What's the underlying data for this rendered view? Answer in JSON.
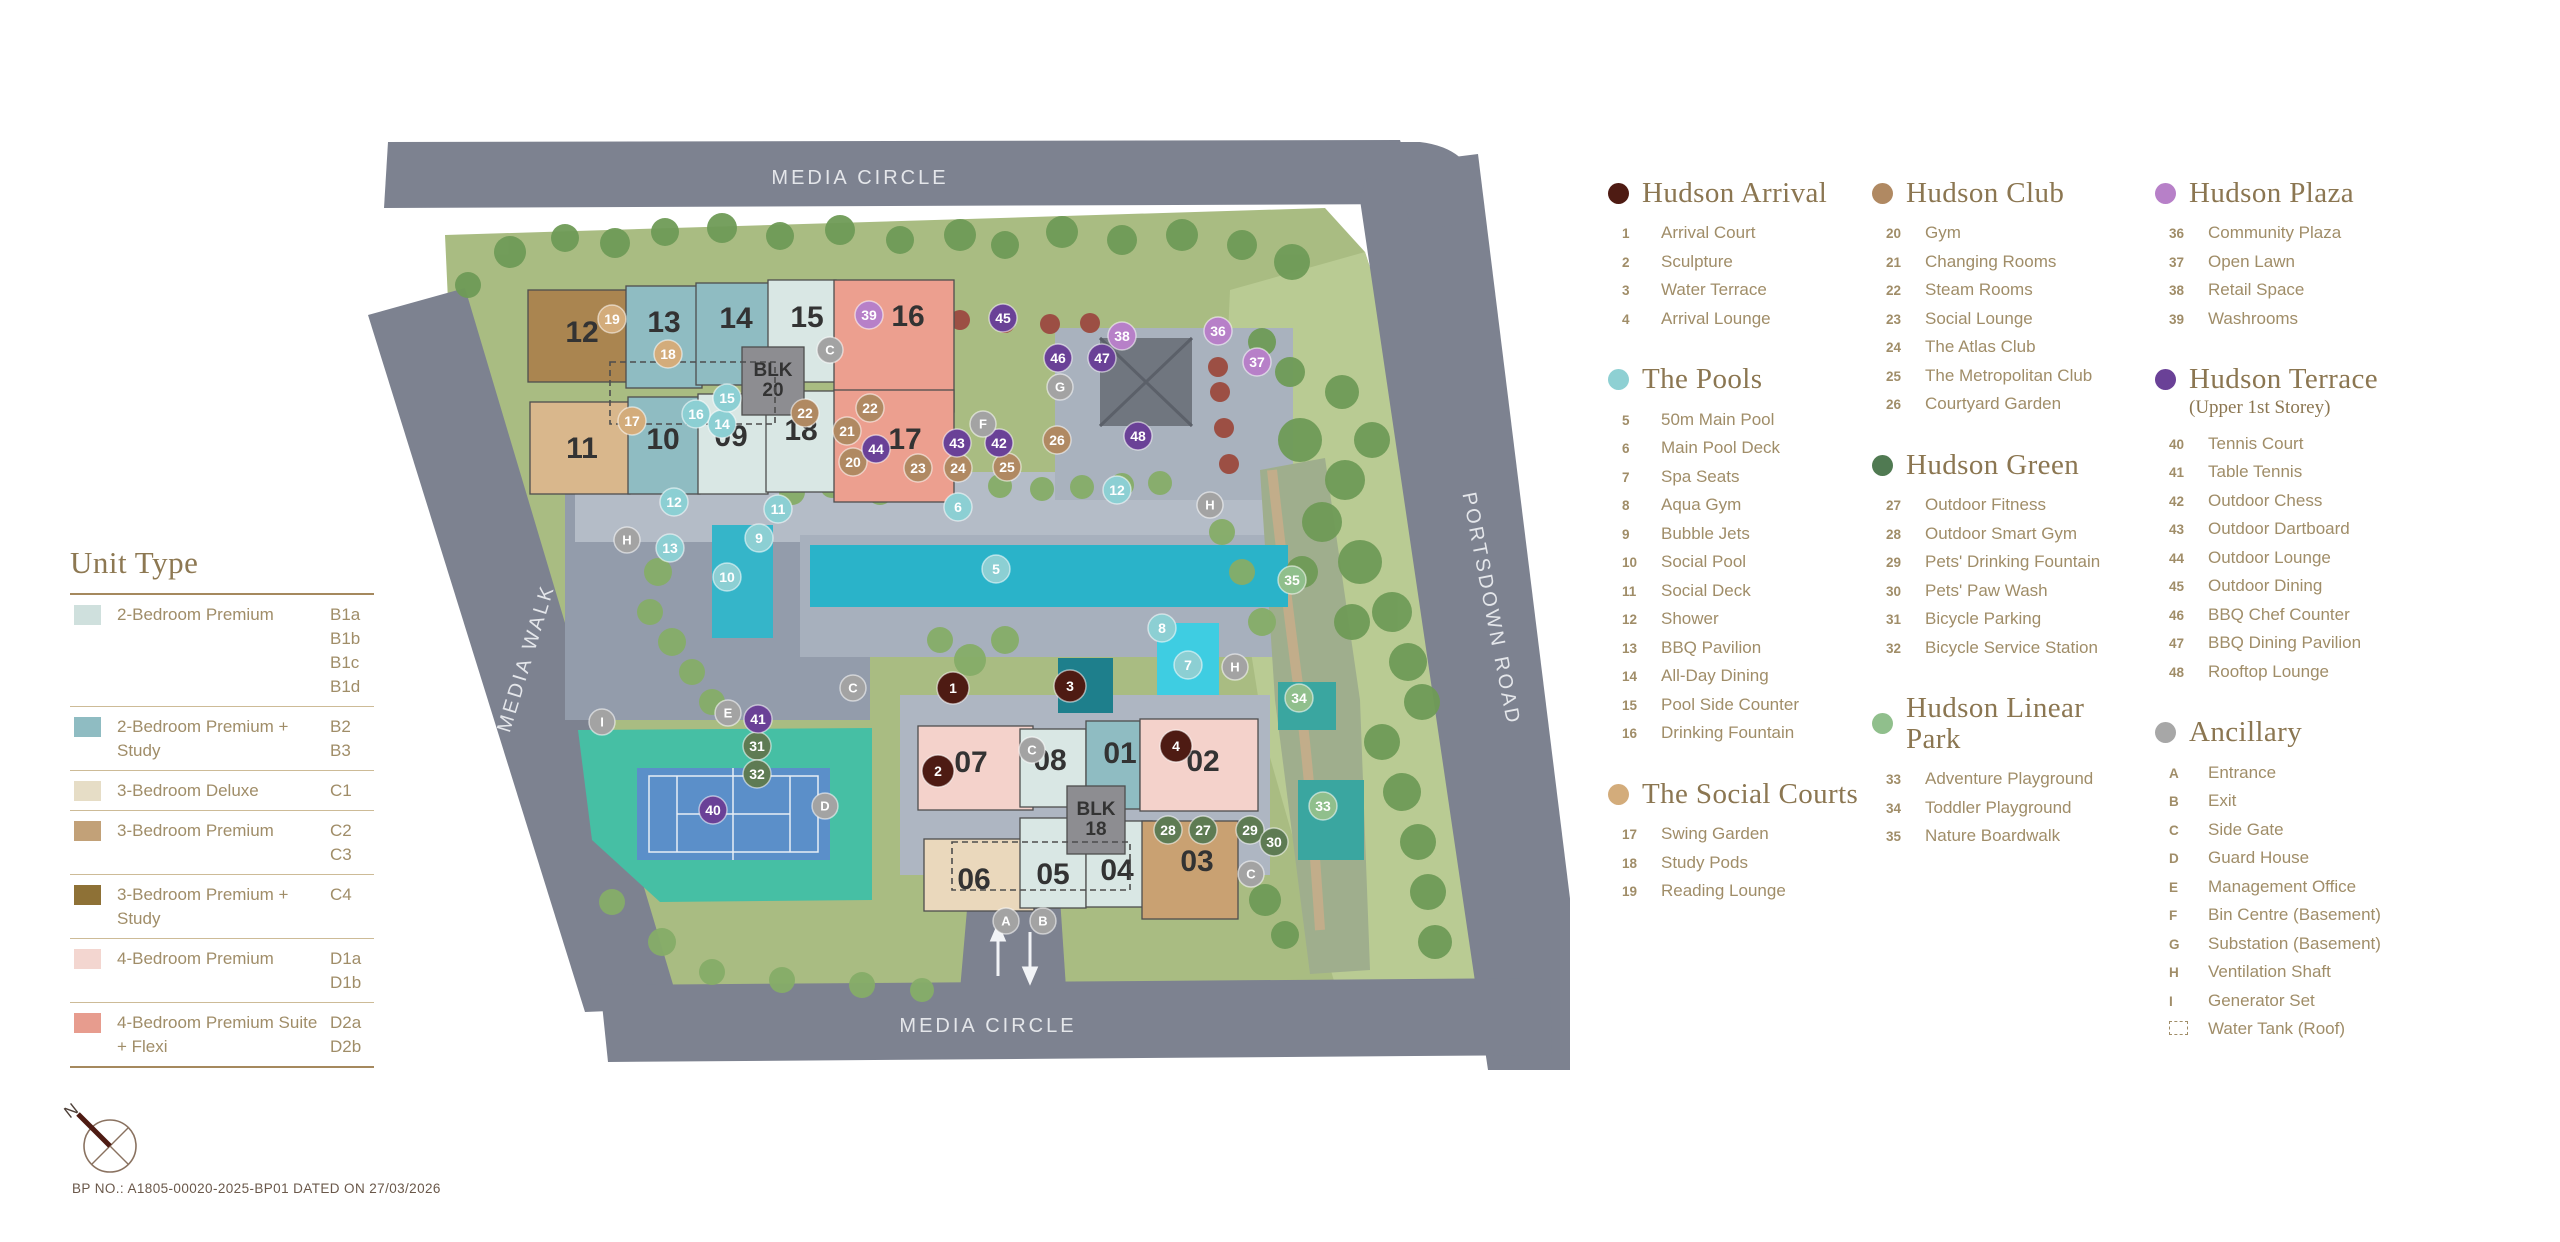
{
  "page": {
    "bp_note": "BP NO.: A1805-00020-2025-BP01 DATED ON 27/03/2026",
    "north_label": "N"
  },
  "unit_legend": {
    "title": "Unit Type",
    "rows": [
      {
        "label": "2-Bedroom Premium",
        "codes": [
          "B1a",
          "B1b",
          "B1c",
          "B1d"
        ],
        "color": "#cfe0dd"
      },
      {
        "label": "2-Bedroom Premium + Study",
        "codes": [
          "B2",
          "B3"
        ],
        "color": "#8fbcc2"
      },
      {
        "label": "3-Bedroom Deluxe",
        "codes": [
          "C1"
        ],
        "color": "#e6ddc6"
      },
      {
        "label": "3-Bedroom Premium",
        "codes": [
          "C2",
          "C3"
        ],
        "color": "#c2a178"
      },
      {
        "label": "3-Bedroom Premium + Study",
        "codes": [
          "C4"
        ],
        "color": "#8e7136"
      },
      {
        "label": "4-Bedroom Premium",
        "codes": [
          "D1a",
          "D1b"
        ],
        "color": "#f3d6d0"
      },
      {
        "label": "4-Bedroom Premium Suite + Flexi",
        "codes": [
          "D2a",
          "D2b"
        ],
        "color": "#e79c8e"
      }
    ]
  },
  "legend_columns": [
    [
      {
        "title": "Hudson Arrival",
        "color": "#4e1b13",
        "items": [
          {
            "k": "1",
            "label": "Arrival Court"
          },
          {
            "k": "2",
            "label": "Sculpture"
          },
          {
            "k": "3",
            "label": "Water Terrace"
          },
          {
            "k": "4",
            "label": "Arrival Lounge"
          }
        ]
      },
      {
        "title": "The Pools",
        "color": "#8ed0d3",
        "items": [
          {
            "k": "5",
            "label": "50m Main Pool"
          },
          {
            "k": "6",
            "label": "Main Pool Deck"
          },
          {
            "k": "7",
            "label": "Spa Seats"
          },
          {
            "k": "8",
            "label": "Aqua Gym"
          },
          {
            "k": "9",
            "label": "Bubble Jets"
          },
          {
            "k": "10",
            "label": "Social Pool"
          },
          {
            "k": "11",
            "label": "Social Deck"
          },
          {
            "k": "12",
            "label": "Shower"
          },
          {
            "k": "13",
            "label": "BBQ Pavilion"
          },
          {
            "k": "14",
            "label": "All-Day Dining"
          },
          {
            "k": "15",
            "label": "Pool Side Counter"
          },
          {
            "k": "16",
            "label": "Drinking Fountain"
          }
        ]
      },
      {
        "title": "The Social Courts",
        "color": "#d3ac7b",
        "items": [
          {
            "k": "17",
            "label": "Swing Garden"
          },
          {
            "k": "18",
            "label": "Study Pods"
          },
          {
            "k": "19",
            "label": "Reading Lounge"
          }
        ]
      }
    ],
    [
      {
        "title": "Hudson Club",
        "color": "#b08962",
        "items": [
          {
            "k": "20",
            "label": "Gym"
          },
          {
            "k": "21",
            "label": "Changing Rooms"
          },
          {
            "k": "22",
            "label": "Steam Rooms"
          },
          {
            "k": "23",
            "label": "Social Lounge"
          },
          {
            "k": "24",
            "label": "The Atlas Club"
          },
          {
            "k": "25",
            "label": "The Metropolitan Club"
          },
          {
            "k": "26",
            "label": "Courtyard Garden"
          }
        ]
      },
      {
        "title": "Hudson Green",
        "color": "#507a52",
        "items": [
          {
            "k": "27",
            "label": "Outdoor Fitness"
          },
          {
            "k": "28",
            "label": "Outdoor Smart Gym"
          },
          {
            "k": "29",
            "label": "Pets' Drinking Fountain"
          },
          {
            "k": "30",
            "label": "Pets' Paw Wash"
          },
          {
            "k": "31",
            "label": "Bicycle Parking"
          },
          {
            "k": "32",
            "label": "Bicycle Service Station"
          }
        ]
      },
      {
        "title": "Hudson Linear Park",
        "color": "#90bf8c",
        "items": [
          {
            "k": "33",
            "label": "Adventure Playground"
          },
          {
            "k": "34",
            "label": "Toddler Playground"
          },
          {
            "k": "35",
            "label": "Nature Boardwalk"
          }
        ]
      }
    ],
    [
      {
        "title": "Hudson Plaza",
        "color": "#b780c8",
        "items": [
          {
            "k": "36",
            "label": "Community Plaza"
          },
          {
            "k": "37",
            "label": "Open Lawn"
          },
          {
            "k": "38",
            "label": "Retail Space"
          },
          {
            "k": "39",
            "label": "Washrooms"
          }
        ]
      },
      {
        "title": "Hudson Terrace",
        "subtitle": "(Upper 1st Storey)",
        "color": "#6a4197",
        "items": [
          {
            "k": "40",
            "label": "Tennis Court"
          },
          {
            "k": "41",
            "label": "Table Tennis"
          },
          {
            "k": "42",
            "label": "Outdoor Chess"
          },
          {
            "k": "43",
            "label": "Outdoor Dartboard"
          },
          {
            "k": "44",
            "label": "Outdoor Lounge"
          },
          {
            "k": "45",
            "label": "Outdoor Dining"
          },
          {
            "k": "46",
            "label": "BBQ Chef Counter"
          },
          {
            "k": "47",
            "label": "BBQ Dining Pavilion"
          },
          {
            "k": "48",
            "label": "Rooftop Lounge"
          }
        ]
      },
      {
        "title": "Ancillary",
        "color": "#a7a7a7",
        "items": [
          {
            "k": "A",
            "label": "Entrance"
          },
          {
            "k": "B",
            "label": "Exit"
          },
          {
            "k": "C",
            "label": "Side Gate"
          },
          {
            "k": "D",
            "label": "Guard House"
          },
          {
            "k": "E",
            "label": "Management Office"
          },
          {
            "k": "F",
            "label": "Bin Centre (Basement)"
          },
          {
            "k": "G",
            "label": "Substation (Basement)"
          },
          {
            "k": "H",
            "label": "Ventilation Shaft"
          },
          {
            "k": "I",
            "label": "Generator Set"
          },
          {
            "k": "",
            "label": "Water Tank (Roof)",
            "dashed": true
          }
        ]
      }
    ]
  ],
  "map": {
    "road_labels": {
      "top": "MEDIA CIRCLE",
      "left": "MEDIA WALK",
      "right": "PORTSDOWN ROAD",
      "bottom": "MEDIA CIRCLE"
    },
    "block_cores": [
      {
        "label": "BLK 20",
        "x": 382,
        "y": 207,
        "w": 62,
        "h": 68,
        "tx": 413,
        "ty": 236
      },
      {
        "label": "BLK 18",
        "x": 707,
        "y": 646,
        "w": 58,
        "h": 68,
        "tx": 736,
        "ty": 675
      }
    ],
    "blocks": [
      {
        "label": "12",
        "color": "#aa8550",
        "x": 168,
        "y": 150,
        "w": 122,
        "h": 92,
        "tx": 222,
        "ty": 202
      },
      {
        "label": "13",
        "color": "#8fbcc2",
        "x": 266,
        "y": 146,
        "w": 76,
        "h": 102,
        "tx": 304,
        "ty": 192
      },
      {
        "label": "14",
        "color": "#8fbcc2",
        "x": 336,
        "y": 143,
        "w": 74,
        "h": 102,
        "tx": 376,
        "ty": 188
      },
      {
        "label": "15",
        "color": "#d9e7e4",
        "x": 408,
        "y": 140,
        "w": 68,
        "h": 102,
        "tx": 447,
        "ty": 187
      },
      {
        "label": "16",
        "color": "#ec9f8f",
        "x": 474,
        "y": 140,
        "w": 120,
        "h": 132,
        "tx": 548,
        "ty": 186
      },
      {
        "label": "11",
        "color": "#d9b78c",
        "x": 170,
        "y": 262,
        "w": 100,
        "h": 92,
        "tx": 222,
        "ty": 318
      },
      {
        "label": "10",
        "color": "#8fbcc2",
        "x": 268,
        "y": 257,
        "w": 72,
        "h": 97,
        "tx": 303,
        "ty": 309
      },
      {
        "label": "09",
        "color": "#d9e7e4",
        "x": 338,
        "y": 254,
        "w": 70,
        "h": 100,
        "tx": 371,
        "ty": 306
      },
      {
        "label": "18",
        "color": "#d9e7e4",
        "x": 406,
        "y": 251,
        "w": 70,
        "h": 101,
        "tx": 441,
        "ty": 300
      },
      {
        "label": "17",
        "color": "#ec9f8f",
        "x": 474,
        "y": 250,
        "w": 120,
        "h": 112,
        "tx": 545,
        "ty": 309
      },
      {
        "label": "07",
        "color": "#f4d2cb",
        "x": 558,
        "y": 586,
        "w": 115,
        "h": 84,
        "tx": 611,
        "ty": 632
      },
      {
        "label": "08",
        "color": "#d9e7e4",
        "x": 660,
        "y": 589,
        "w": 66,
        "h": 78,
        "tx": 690,
        "ty": 630
      },
      {
        "label": "01",
        "color": "#8fbcc2",
        "x": 726,
        "y": 581,
        "w": 54,
        "h": 88,
        "tx": 760,
        "ty": 623
      },
      {
        "label": "02",
        "color": "#f4d2cb",
        "x": 780,
        "y": 579,
        "w": 118,
        "h": 92,
        "tx": 843,
        "ty": 631
      },
      {
        "label": "06",
        "color": "#ead8bc",
        "x": 564,
        "y": 699,
        "w": 110,
        "h": 72,
        "tx": 614,
        "ty": 749
      },
      {
        "label": "05",
        "color": "#d9e7e4",
        "x": 660,
        "y": 678,
        "w": 66,
        "h": 90,
        "tx": 693,
        "ty": 744
      },
      {
        "label": "04",
        "color": "#d9e7e4",
        "x": 726,
        "y": 681,
        "w": 66,
        "h": 86,
        "tx": 757,
        "ty": 740
      },
      {
        "label": "03",
        "color": "#c9a172",
        "x": 782,
        "y": 681,
        "w": 96,
        "h": 98,
        "tx": 837,
        "ty": 731
      }
    ],
    "marker_colors": {
      "arrival": "#4e1b13",
      "pools": "#8ccfd3",
      "social": "#d3ac7b",
      "club": "#b08962",
      "green": "#5e7b53",
      "linear": "#90bf8c",
      "plaza": "#b780c8",
      "terrace": "#6a4197",
      "anc": "#a3a3a3"
    },
    "markers": [
      {
        "t": "1",
        "c": "arrival",
        "x": 593,
        "y": 548
      },
      {
        "t": "2",
        "c": "arrival",
        "x": 578,
        "y": 631
      },
      {
        "t": "3",
        "c": "arrival",
        "x": 710,
        "y": 546
      },
      {
        "t": "4",
        "c": "arrival",
        "x": 816,
        "y": 606
      },
      {
        "t": "5",
        "c": "pools",
        "x": 636,
        "y": 429
      },
      {
        "t": "6",
        "c": "pools",
        "x": 598,
        "y": 367
      },
      {
        "t": "7",
        "c": "pools",
        "x": 828,
        "y": 525
      },
      {
        "t": "8",
        "c": "pools",
        "x": 802,
        "y": 488
      },
      {
        "t": "9",
        "c": "pools",
        "x": 399,
        "y": 398
      },
      {
        "t": "10",
        "c": "pools",
        "x": 367,
        "y": 437
      },
      {
        "t": "11",
        "c": "pools",
        "x": 418,
        "y": 369
      },
      {
        "t": "12",
        "c": "pools",
        "x": 314,
        "y": 362
      },
      {
        "t": "12",
        "c": "pools",
        "x": 757,
        "y": 350
      },
      {
        "t": "13",
        "c": "pools",
        "x": 310,
        "y": 408
      },
      {
        "t": "14",
        "c": "pools",
        "x": 362,
        "y": 284
      },
      {
        "t": "15",
        "c": "pools",
        "x": 367,
        "y": 258
      },
      {
        "t": "16",
        "c": "pools",
        "x": 336,
        "y": 274
      },
      {
        "t": "17",
        "c": "social",
        "x": 272,
        "y": 281
      },
      {
        "t": "18",
        "c": "social",
        "x": 308,
        "y": 214
      },
      {
        "t": "19",
        "c": "social",
        "x": 252,
        "y": 179
      },
      {
        "t": "20",
        "c": "club",
        "x": 493,
        "y": 322
      },
      {
        "t": "21",
        "c": "club",
        "x": 487,
        "y": 291
      },
      {
        "t": "22",
        "c": "club",
        "x": 445,
        "y": 273
      },
      {
        "t": "22",
        "c": "club",
        "x": 510,
        "y": 268
      },
      {
        "t": "23",
        "c": "club",
        "x": 558,
        "y": 328
      },
      {
        "t": "24",
        "c": "club",
        "x": 598,
        "y": 328
      },
      {
        "t": "25",
        "c": "club",
        "x": 647,
        "y": 327
      },
      {
        "t": "26",
        "c": "club",
        "x": 697,
        "y": 300
      },
      {
        "t": "27",
        "c": "green",
        "x": 843,
        "y": 690
      },
      {
        "t": "28",
        "c": "green",
        "x": 808,
        "y": 690
      },
      {
        "t": "29",
        "c": "green",
        "x": 890,
        "y": 690
      },
      {
        "t": "30",
        "c": "green",
        "x": 914,
        "y": 702
      },
      {
        "t": "31",
        "c": "green",
        "x": 397,
        "y": 606
      },
      {
        "t": "32",
        "c": "green",
        "x": 397,
        "y": 634
      },
      {
        "t": "33",
        "c": "linear",
        "x": 963,
        "y": 666
      },
      {
        "t": "34",
        "c": "linear",
        "x": 939,
        "y": 558
      },
      {
        "t": "35",
        "c": "linear",
        "x": 932,
        "y": 440
      },
      {
        "t": "36",
        "c": "plaza",
        "x": 858,
        "y": 191
      },
      {
        "t": "37",
        "c": "plaza",
        "x": 897,
        "y": 222
      },
      {
        "t": "38",
        "c": "plaza",
        "x": 762,
        "y": 196
      },
      {
        "t": "39",
        "c": "plaza",
        "x": 509,
        "y": 175
      },
      {
        "t": "40",
        "c": "terrace",
        "x": 353,
        "y": 670
      },
      {
        "t": "41",
        "c": "terrace",
        "x": 398,
        "y": 579
      },
      {
        "t": "42",
        "c": "terrace",
        "x": 639,
        "y": 303
      },
      {
        "t": "43",
        "c": "terrace",
        "x": 597,
        "y": 303
      },
      {
        "t": "44",
        "c": "terrace",
        "x": 516,
        "y": 309
      },
      {
        "t": "45",
        "c": "terrace",
        "x": 643,
        "y": 178
      },
      {
        "t": "46",
        "c": "terrace",
        "x": 698,
        "y": 218
      },
      {
        "t": "47",
        "c": "terrace",
        "x": 742,
        "y": 218
      },
      {
        "t": "48",
        "c": "terrace",
        "x": 778,
        "y": 296
      },
      {
        "t": "A",
        "c": "anc",
        "x": 646,
        "y": 781
      },
      {
        "t": "B",
        "c": "anc",
        "x": 683,
        "y": 781
      },
      {
        "t": "C",
        "c": "anc",
        "x": 470,
        "y": 210
      },
      {
        "t": "C",
        "c": "anc",
        "x": 493,
        "y": 548
      },
      {
        "t": "C",
        "c": "anc",
        "x": 672,
        "y": 610
      },
      {
        "t": "C",
        "c": "anc",
        "x": 891,
        "y": 734
      },
      {
        "t": "D",
        "c": "anc",
        "x": 465,
        "y": 666
      },
      {
        "t": "E",
        "c": "anc",
        "x": 368,
        "y": 573
      },
      {
        "t": "F",
        "c": "anc",
        "x": 623,
        "y": 284
      },
      {
        "t": "G",
        "c": "anc",
        "x": 700,
        "y": 247
      },
      {
        "t": "H",
        "c": "anc",
        "x": 267,
        "y": 400
      },
      {
        "t": "H",
        "c": "anc",
        "x": 850,
        "y": 365
      },
      {
        "t": "H",
        "c": "anc",
        "x": 875,
        "y": 527
      },
      {
        "t": "I",
        "c": "anc",
        "x": 242,
        "y": 582
      }
    ]
  }
}
